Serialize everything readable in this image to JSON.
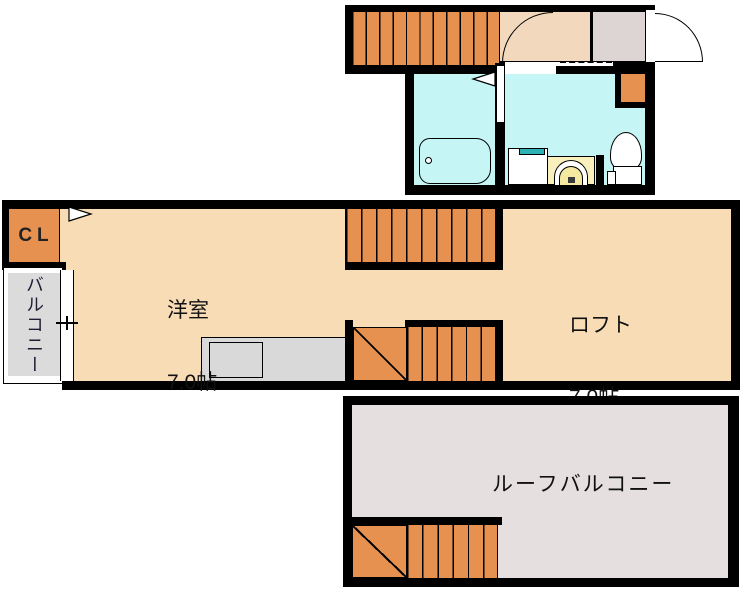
{
  "labels": {
    "closet": "CL",
    "balcony": "バルコニー",
    "western_room": {
      "name": "洋室",
      "size": "7.0帖"
    },
    "loft": {
      "name": "ロフト",
      "size": "7.0帖"
    },
    "roof_balcony": "ルーフバルコニー"
  },
  "fixtures": {
    "bathtub": "bathtub",
    "toilet": "toilet",
    "washbasin": "washbasin",
    "laundry_pan": "washing-machine-pan",
    "shoe_cabinet": "shoe-cabinet",
    "kitchen": "kitchen-counter",
    "entrance_door": "entrance-door-swing",
    "interior_door": "interior-door-swing"
  },
  "colors": {
    "wall": "#000000",
    "floor": "#f8dcb6",
    "entry": "#f2d8bd",
    "stair": "#e6914f",
    "bath": "#c6f5f6",
    "genkan": "#ddd5d3",
    "balcony": "#dbdbdb",
    "roof": "#e5dfdf",
    "kitchen": "#d9d9d9",
    "cream": "#f8f0bd",
    "bowl": "#f5e8a0",
    "teal": "#2cb2b4"
  }
}
